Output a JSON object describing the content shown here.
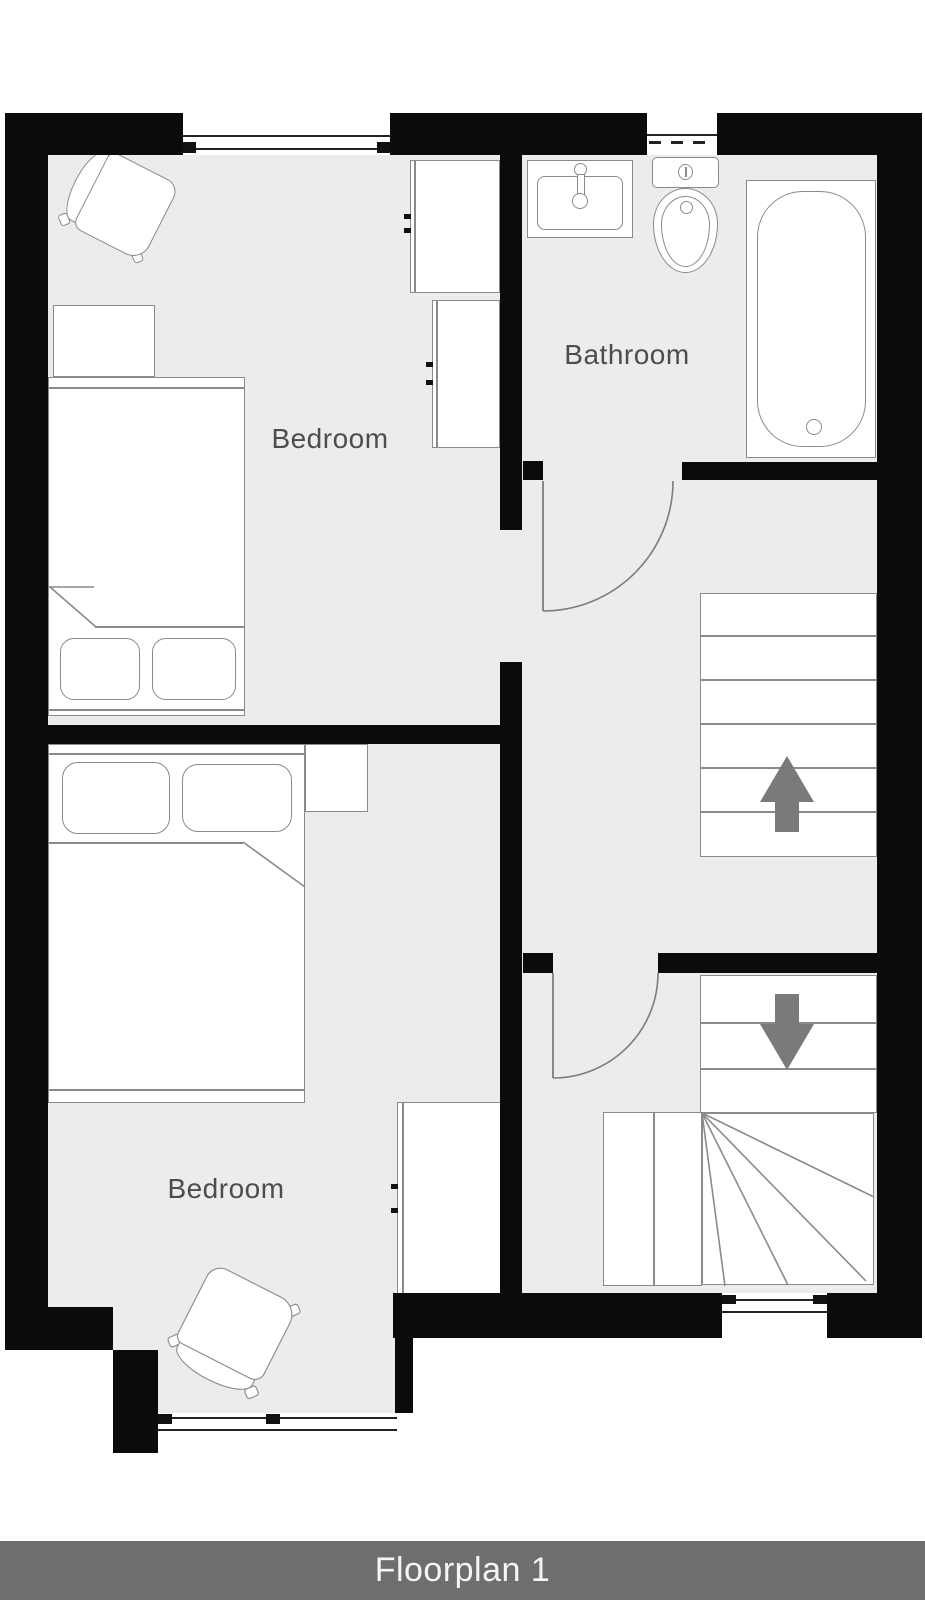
{
  "rooms": [
    {
      "label": "Bedroom"
    },
    {
      "label": "Bathroom"
    },
    {
      "label": "Bedroom"
    }
  ],
  "footer": {
    "label": "Floorplan 1"
  },
  "palette": {
    "wall": "#0b0b0b",
    "floor": "#ececec",
    "furniture_line": "#8a8a8a",
    "window_line": "#232323",
    "arrow": "#7a7a7a",
    "label_text": "#4d4d4d",
    "footer_bg": "#6e6e6e",
    "footer_text": "#f5f5f5"
  }
}
